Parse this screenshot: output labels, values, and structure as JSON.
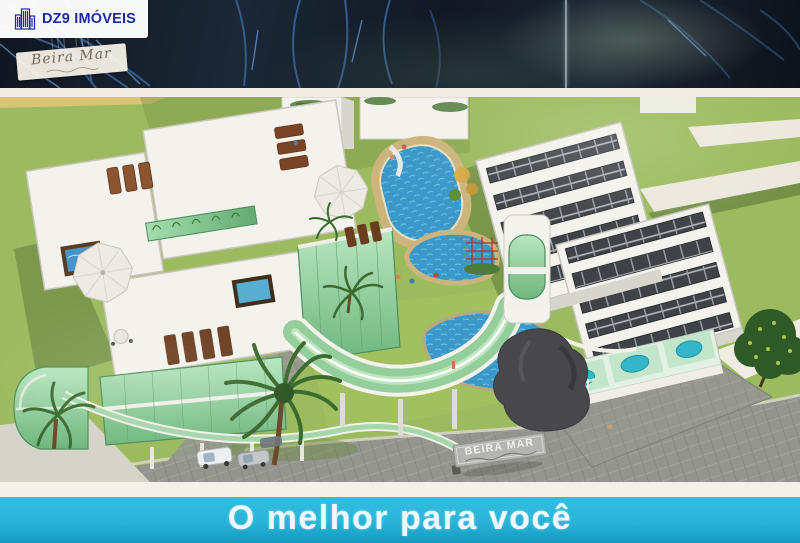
{
  "watermark": {
    "brand": "DZ9 IMÓVEIS"
  },
  "project_emblem": {
    "name": "Beira Mar"
  },
  "entrance_sign": {
    "text": "BEIRA MAR"
  },
  "slogan": {
    "text": "O melhor para você"
  },
  "colors": {
    "navy_band": "#131c29",
    "frond_blue": "#3f6ea8",
    "paper_white": "#f1ede3",
    "lawn_green": "#9cba5e",
    "lawn_shadow": "#6e8a44",
    "sand": "#d9c473",
    "building_white": "#f3f2ec",
    "wall_shadow": "#d8d5cc",
    "glass_green": "#8ecb98",
    "pool_blue": "#3b98c8",
    "deck_tan": "#ccb47d",
    "solar_panel": "#3f4347",
    "path_gray": "#94958f",
    "lounger_brown": "#7a4526",
    "sculpture_gray": "#47474c",
    "tree_green": "#3c6b2e",
    "cyan_band": "#29b4d9",
    "slogan_text": "#eef9fd",
    "dz9_blue": "#1d2b9e",
    "sign_gray": "#b4b5b0"
  }
}
